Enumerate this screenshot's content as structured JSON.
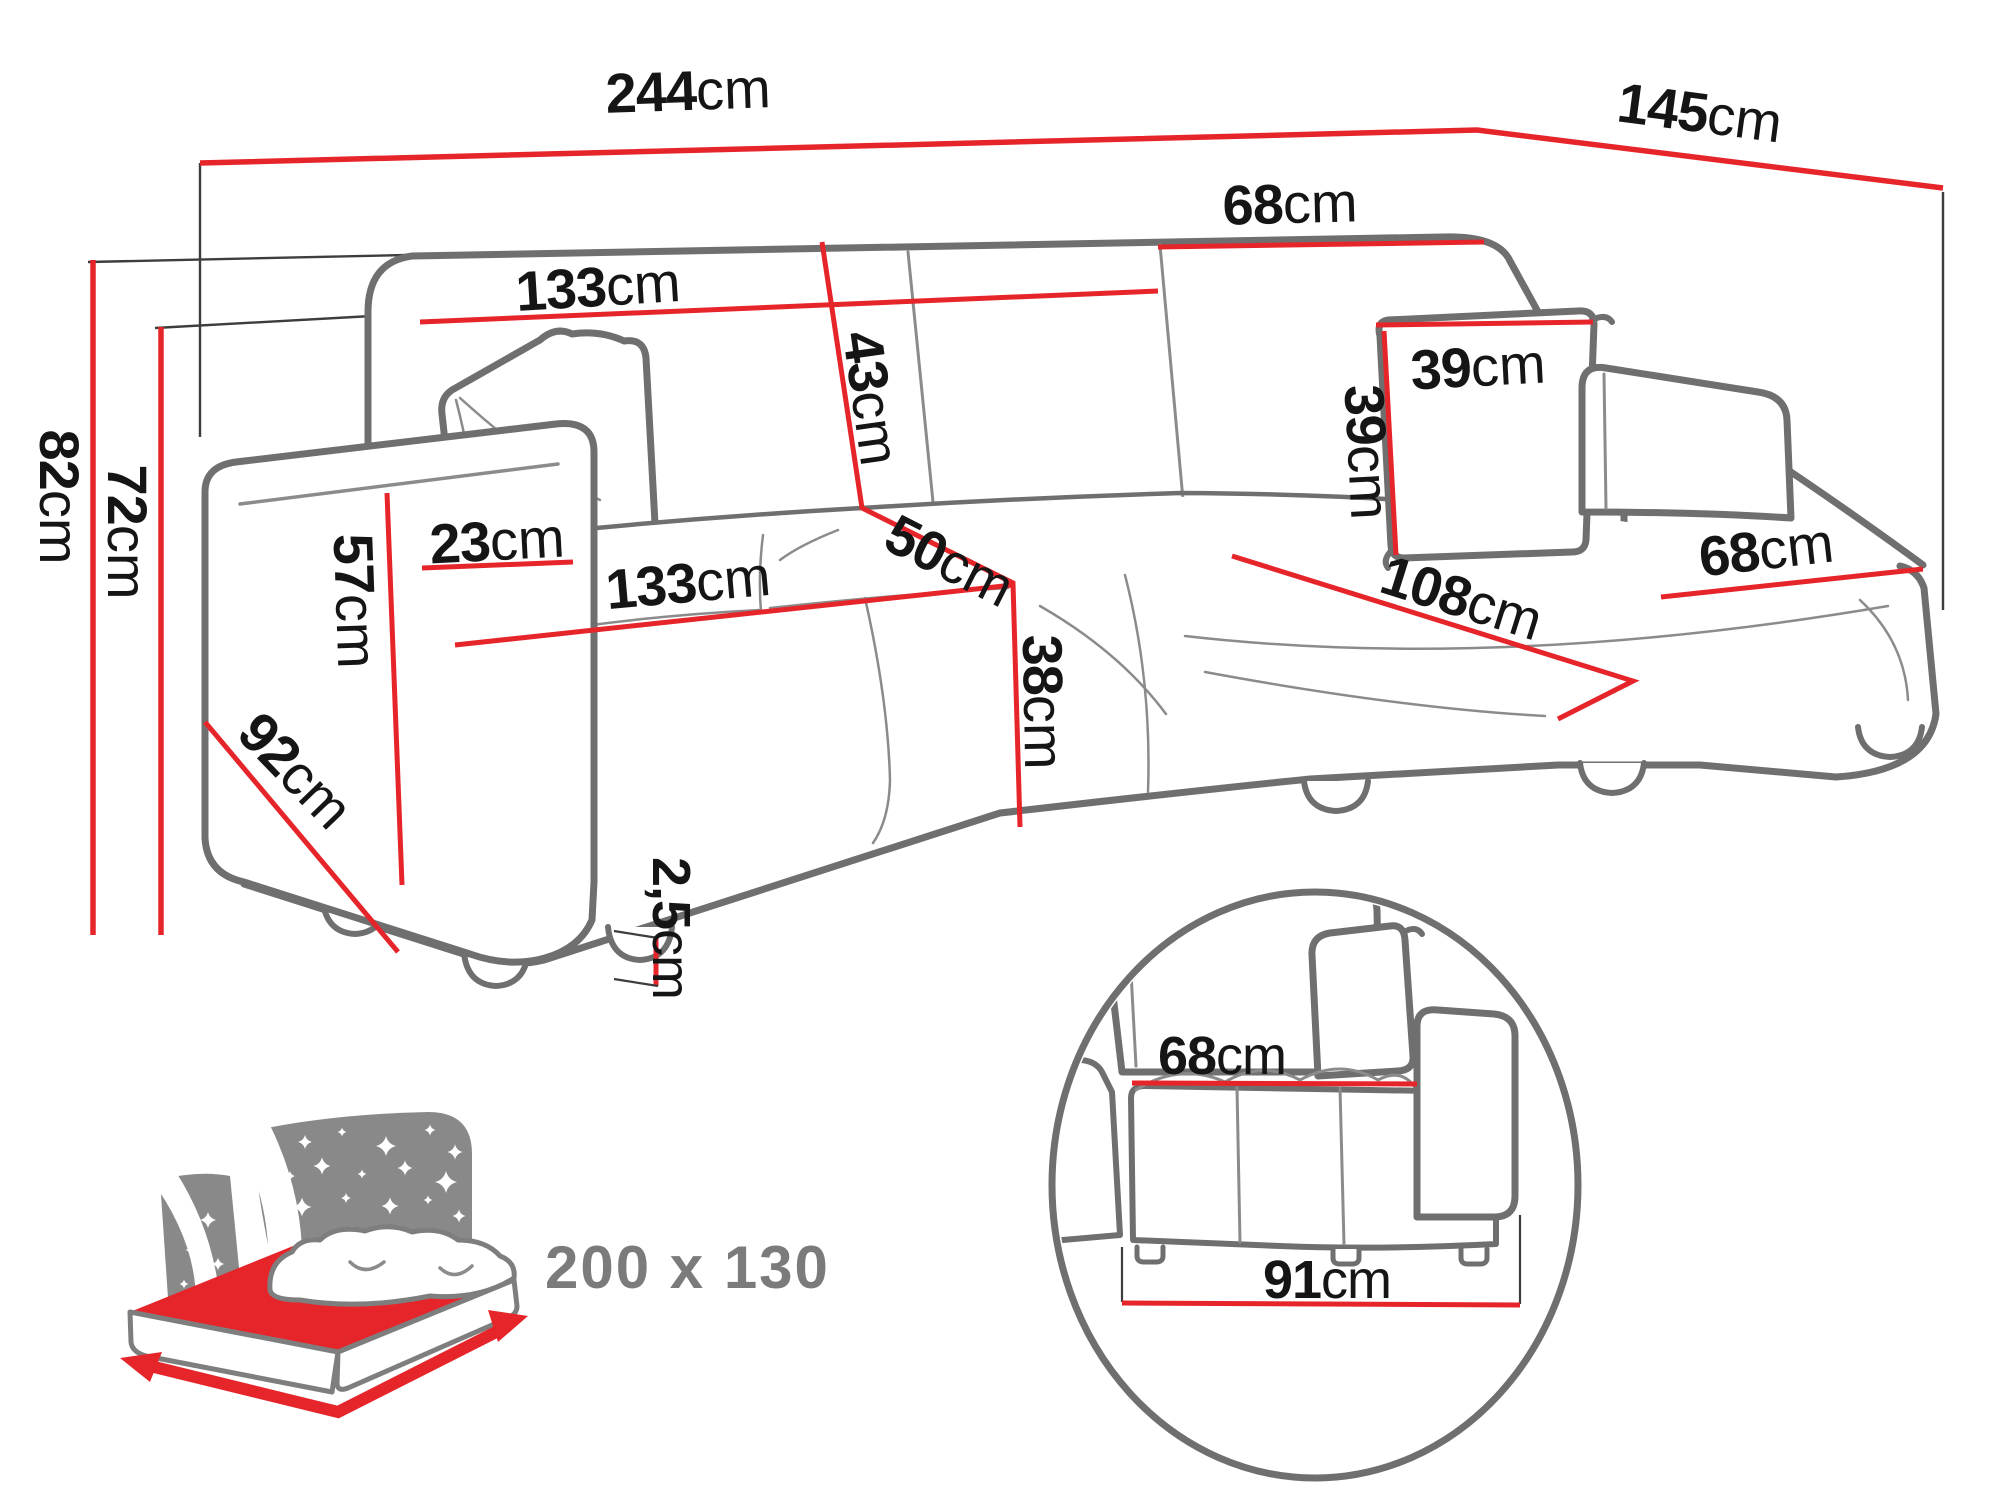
{
  "diagram": {
    "type": "corner-sofa-dimension-drawing",
    "measurements": {
      "total_width": {
        "value": "244",
        "unit": "cm"
      },
      "total_depth": {
        "value": "145",
        "unit": "cm"
      },
      "backrest_section_width": {
        "value": "133",
        "unit": "cm"
      },
      "backrest_corner_width": {
        "value": "68",
        "unit": "cm"
      },
      "backrest_cushion_height": {
        "value": "43",
        "unit": "cm"
      },
      "seat_depth": {
        "value": "50",
        "unit": "cm"
      },
      "pillow_width": {
        "value": "39",
        "unit": "cm"
      },
      "pillow_height": {
        "value": "39",
        "unit": "cm"
      },
      "total_height": {
        "value": "82",
        "unit": "cm"
      },
      "backrest_height": {
        "value": "72",
        "unit": "cm"
      },
      "armrest_width": {
        "value": "23",
        "unit": "cm"
      },
      "armrest_height": {
        "value": "57",
        "unit": "cm"
      },
      "side_depth": {
        "value": "92",
        "unit": "cm"
      },
      "seat_width": {
        "value": "133",
        "unit": "cm"
      },
      "seat_height": {
        "value": "38",
        "unit": "cm"
      },
      "chaise_length": {
        "value": "108",
        "unit": "cm"
      },
      "chaise_width": {
        "value": "68",
        "unit": "cm"
      },
      "leg_height": {
        "value": "2,5",
        "unit": "cm"
      }
    },
    "detail_inset": {
      "seat_width": {
        "value": "68",
        "unit": "cm"
      },
      "base_depth": {
        "value": "91",
        "unit": "cm"
      }
    },
    "sleeping_area": {
      "label": "200 x 130"
    },
    "colors": {
      "dimension_red": "#e6252b",
      "outline_gray": "#6f6f6f",
      "label_black": "#151515",
      "headboard_gray": "#898989",
      "sleeping_text_gray": "#7b7b7b"
    }
  }
}
